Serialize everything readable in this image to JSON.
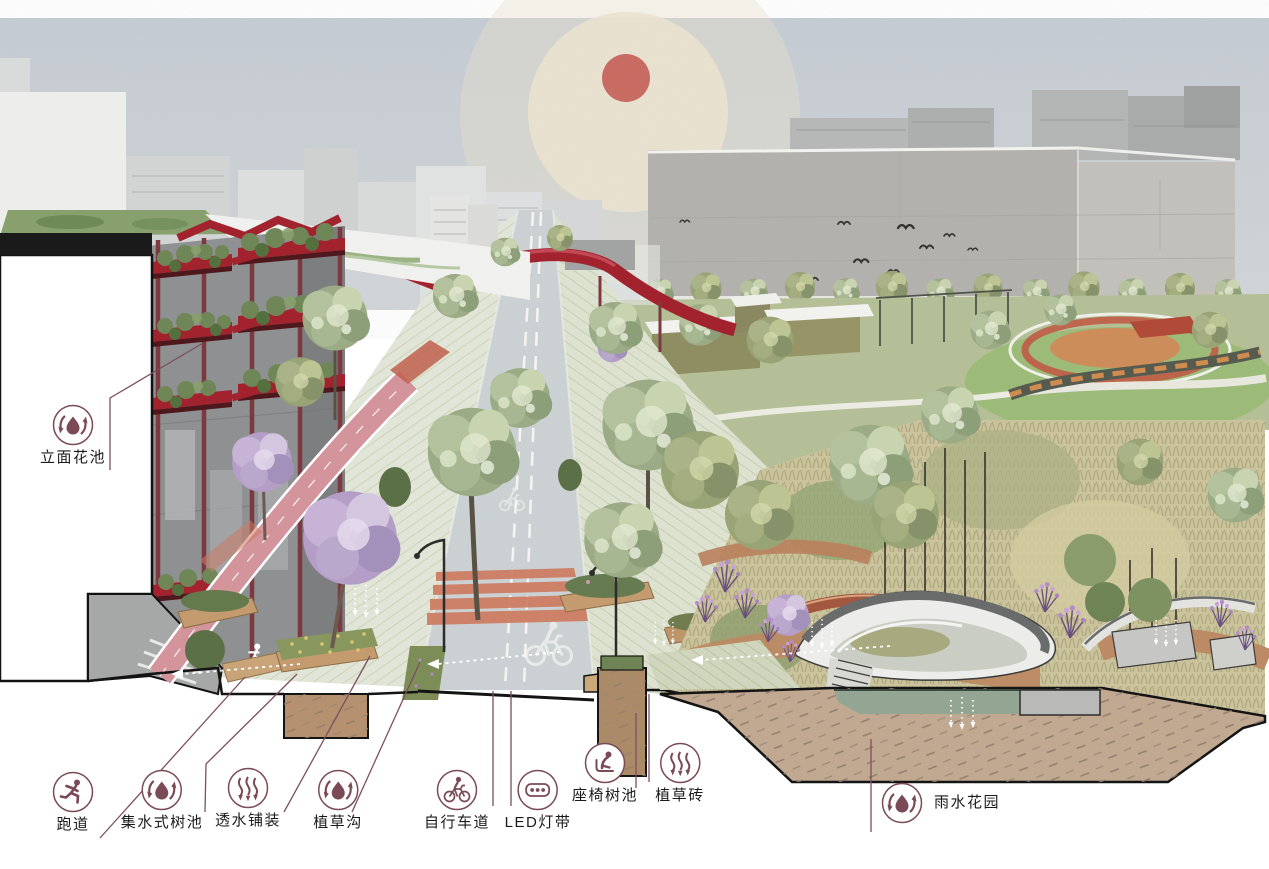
{
  "callouts": [
    {
      "id": "facade-planter",
      "label": "立面花池",
      "icon": "water-cycle-icon"
    },
    {
      "id": "running-track",
      "label": "跑道",
      "icon": "runner-icon"
    },
    {
      "id": "water-collecting-tree-pit",
      "label": "集水式树池",
      "icon": "water-cycle-icon"
    },
    {
      "id": "permeable-paving",
      "label": "透水铺装",
      "icon": "infiltration-arrows-icon"
    },
    {
      "id": "grass-swale",
      "label": "植草沟",
      "icon": "water-cycle-icon"
    },
    {
      "id": "bike-lane",
      "label": "自行车道",
      "icon": "cyclist-icon"
    },
    {
      "id": "led-light-strip",
      "label": "LED灯带",
      "icon": "led-strip-icon"
    },
    {
      "id": "seat-tree-pit",
      "label": "座椅树池",
      "icon": "seated-person-icon"
    },
    {
      "id": "grass-paving-brick",
      "label": "植草砖",
      "icon": "infiltration-arrows-icon"
    },
    {
      "id": "rain-garden",
      "label": "雨水花园",
      "icon": "water-cycle-icon"
    }
  ],
  "palette": {
    "annotation": "#7b4a57",
    "structure_red": "#a2222e",
    "sun": "#c9695f",
    "sun_halo": "#ece3ce",
    "sky": "#c9ced5",
    "soil": "#c0a891",
    "water": "#93a694",
    "track_pink": "#d3949c",
    "jacaranda": "#bda7cf",
    "foliage": "#9fb089",
    "bike_lane": "#cbd1d3",
    "paving": "#e0e4d6"
  }
}
